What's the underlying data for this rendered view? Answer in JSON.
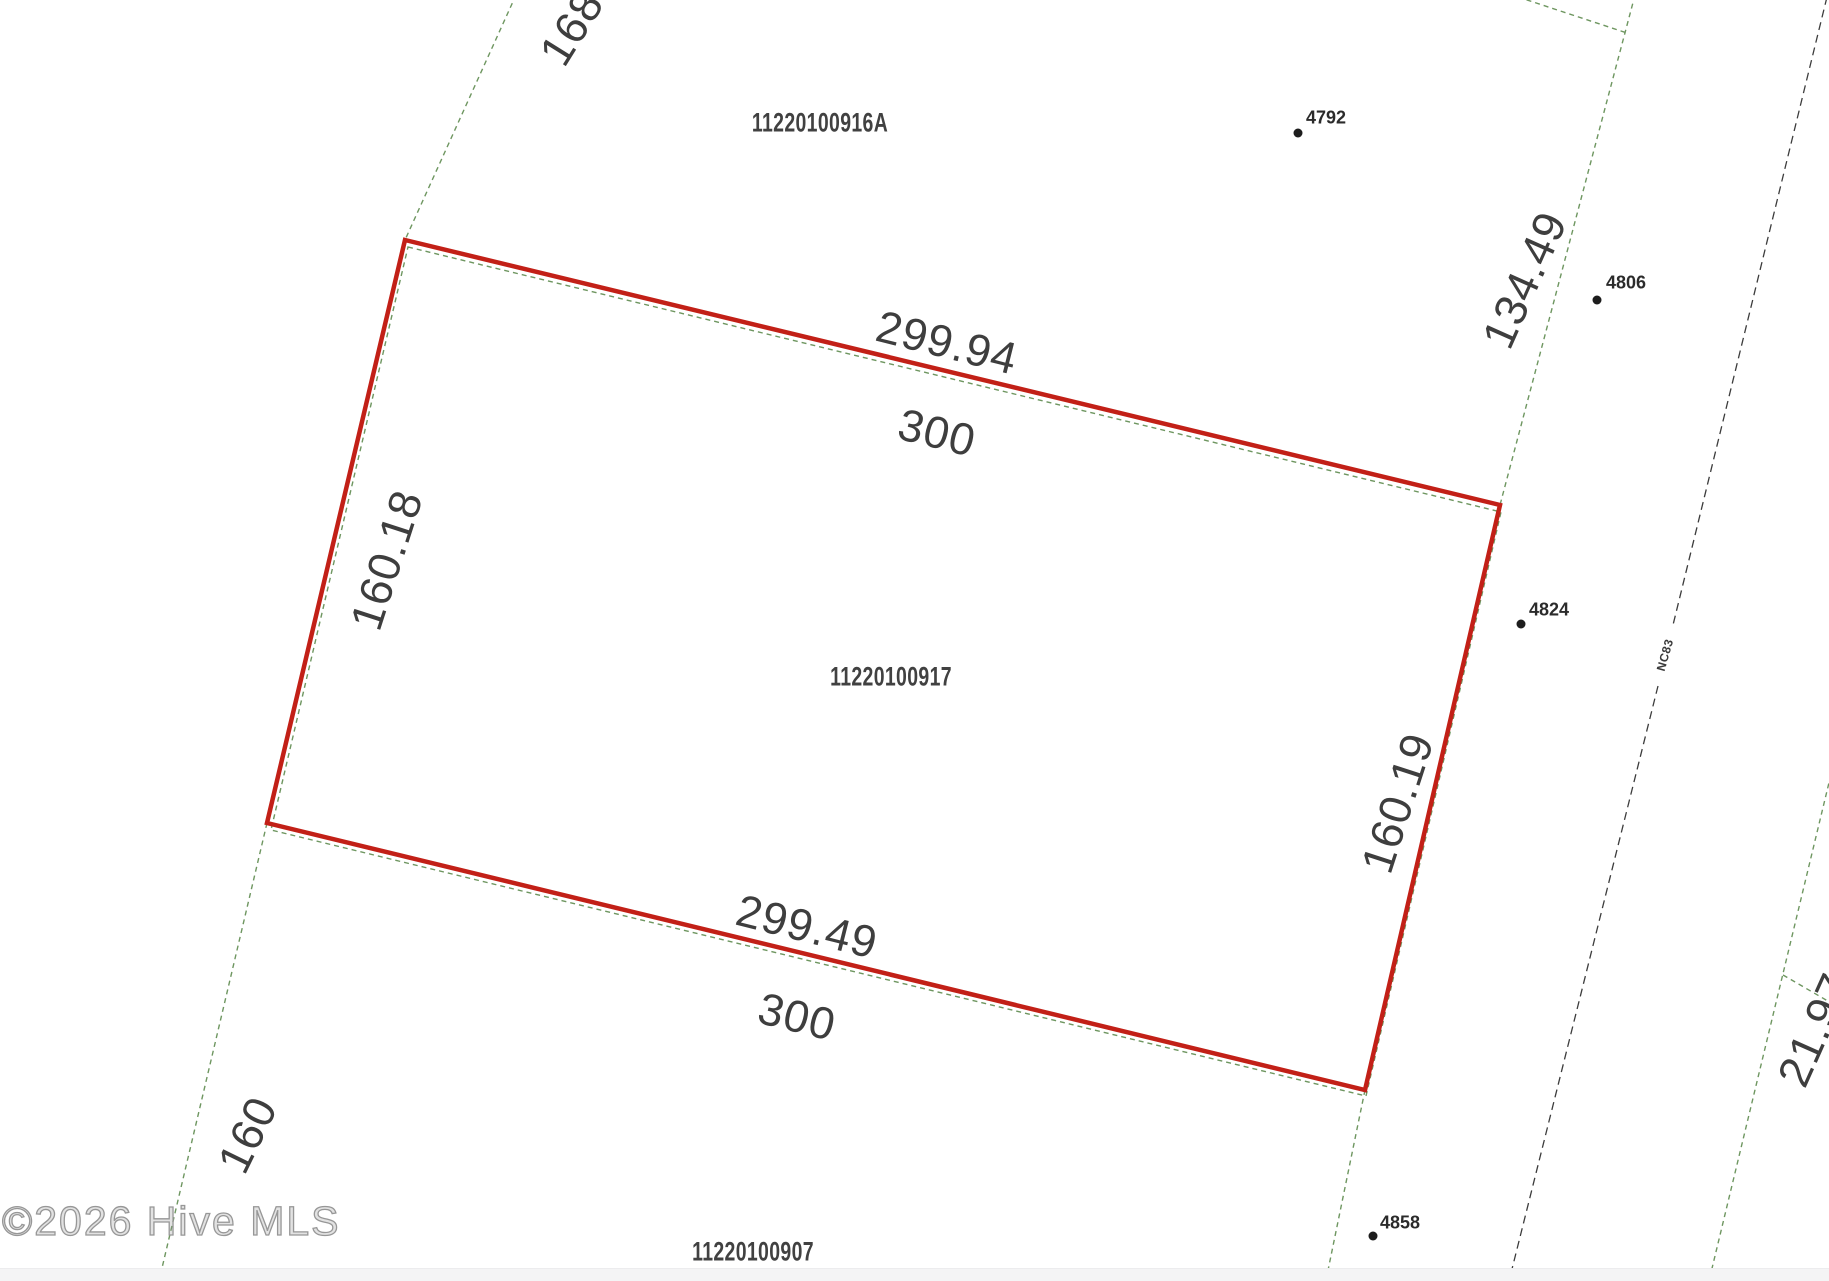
{
  "map": {
    "watermark": "©2026 Hive MLS",
    "road": {
      "name": "NC83"
    },
    "parcel_ids": {
      "north": "11220100916A",
      "subject": "11220100917",
      "south": "11220100907"
    },
    "dimensions": {
      "top_survey": "299.94",
      "top_round": "300",
      "bottom_survey": "299.49",
      "bottom_round": "300",
      "west": "160.18",
      "east": "160.19",
      "northeast_road": "134.49",
      "northwest_cutoff": "168",
      "southwest": "160",
      "east_road_cutoff": "21.97"
    },
    "address_points": [
      {
        "number": "4792"
      },
      {
        "number": "4806"
      },
      {
        "number": "4824"
      },
      {
        "number": "4858"
      }
    ],
    "colors": {
      "parcel_highlight": "#c22017",
      "boundary_green": "#6e9660",
      "road_dash": "#3c3c3c",
      "dimension_text": "#3e3e3e",
      "footer_strip": "#f4f4f5"
    }
  }
}
